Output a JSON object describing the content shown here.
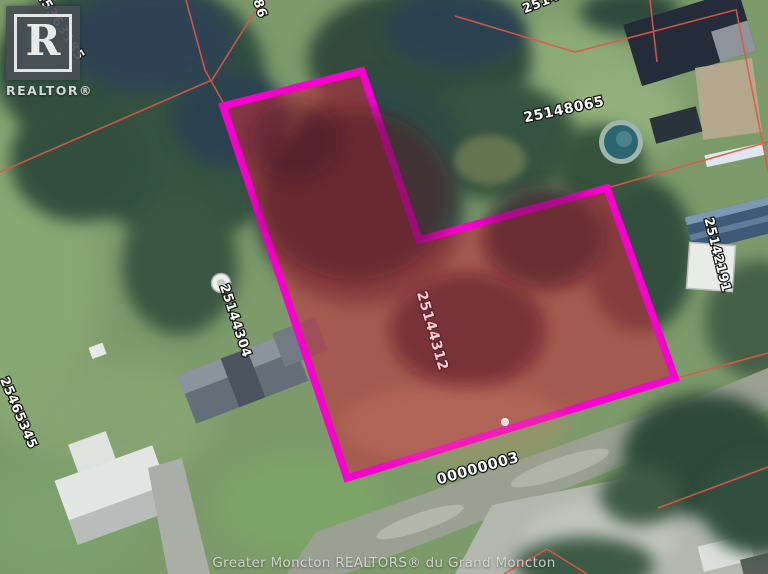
{
  "watermark": {
    "logo_r": "R",
    "wordmark": "REALTOR®"
  },
  "attribution": {
    "text": "Greater Moncton REALTORS® du Grand Moncton"
  },
  "map": {
    "type": "aerial-parcel-map",
    "highlighted_parcel_id": "25144312",
    "road_label": "00000003",
    "parcel_ids": {
      "top_left": "25363185",
      "top_partial_a": "586",
      "top_partial_b": "2514",
      "north": "25148065",
      "east": "25142191",
      "west": "25144304",
      "southwest": "25465345"
    },
    "colors": {
      "lot_outline": "#f800cf",
      "lot_fill": "#b9323c",
      "parcel_line": "#e05648"
    }
  }
}
